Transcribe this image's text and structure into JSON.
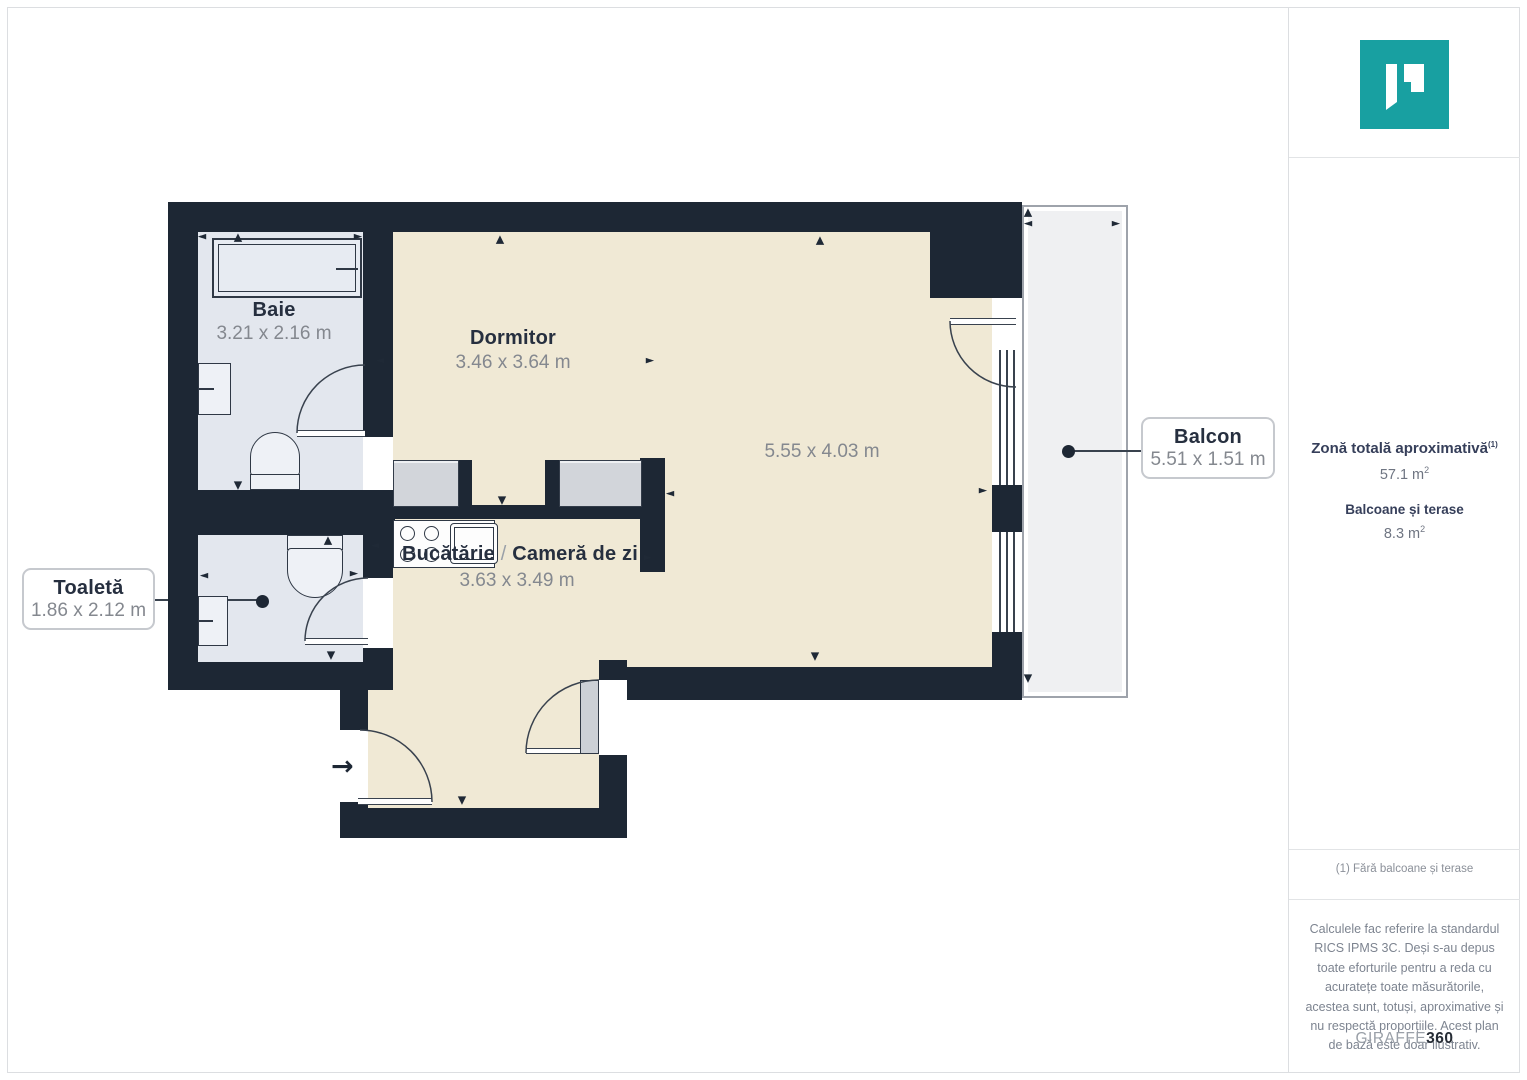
{
  "floorplan": {
    "rooms": {
      "baie": {
        "name": "Baie",
        "dims": "3.21 x 2.16 m"
      },
      "dormitor": {
        "name": "Dormitor",
        "dims": "3.46 x 3.64 m"
      },
      "living": {
        "dims": "5.55 x 4.03 m"
      },
      "kitchen_living": {
        "kitchen": "Bucătărie",
        "separator": "/",
        "living": "Cameră de zi",
        "dims": "3.63 x 3.49 m"
      },
      "toaleta": {
        "name": "Toaletă",
        "dims": "1.86 x 2.12 m"
      },
      "balcon": {
        "name": "Balcon",
        "dims": "5.51 x 1.51 m"
      }
    },
    "entry_arrow": "→",
    "arrow_glyphs": {
      "up": "▲",
      "down": "▼",
      "left": "◄",
      "right": "►"
    },
    "arrows": [
      {
        "g": "left",
        "x": 202,
        "y": 236
      },
      {
        "g": "up",
        "x": 238,
        "y": 237
      },
      {
        "g": "right",
        "x": 358,
        "y": 236
      },
      {
        "g": "up",
        "x": 500,
        "y": 239
      },
      {
        "g": "up",
        "x": 820,
        "y": 240
      },
      {
        "g": "left",
        "x": 380,
        "y": 360
      },
      {
        "g": "right",
        "x": 650,
        "y": 360
      },
      {
        "g": "down",
        "x": 238,
        "y": 485
      },
      {
        "g": "down",
        "x": 502,
        "y": 500
      },
      {
        "g": "left",
        "x": 670,
        "y": 493
      },
      {
        "g": "right",
        "x": 983,
        "y": 490
      },
      {
        "g": "down",
        "x": 815,
        "y": 656
      },
      {
        "g": "up",
        "x": 1028,
        "y": 212
      },
      {
        "g": "left",
        "x": 1028,
        "y": 223
      },
      {
        "g": "right",
        "x": 1116,
        "y": 223
      },
      {
        "g": "down",
        "x": 1028,
        "y": 678
      },
      {
        "g": "left",
        "x": 204,
        "y": 575
      },
      {
        "g": "right",
        "x": 354,
        "y": 573
      },
      {
        "g": "up",
        "x": 328,
        "y": 540
      },
      {
        "g": "down",
        "x": 331,
        "y": 655
      },
      {
        "g": "down",
        "x": 462,
        "y": 800
      },
      {
        "g": "left",
        "x": 375,
        "y": 545
      },
      {
        "g": "right",
        "x": 648,
        "y": 557
      }
    ],
    "colors": {
      "wall": "#1d2734",
      "floor": "#f0e9d5",
      "wet_floor": "#e3e7ee",
      "balcony": "#eff0f2",
      "brand_teal": "#18a0a1"
    }
  },
  "sidebar": {
    "area_title": "Zonă totală aproximativă",
    "area_title_sup": "(1)",
    "area_value": "57.1 m",
    "area_value_sup": "2",
    "balcony_title": "Balcoane și terase",
    "balcony_value": "8.3 m",
    "balcony_value_sup": "2",
    "footnote": "(1) Fără balcoane și terase",
    "disclaimer": "Calculele fac referire la standardul RICS IPMS 3C. Deși s-au depus toate eforturile pentru a reda cu acuratețe toate măsurătorile, acestea sunt, totuși, aproximative și nu respectă proporțiile. Acest plan de bază este doar ilustrativ.",
    "brand_light": "GIRAFFE",
    "brand_bold": "360"
  }
}
